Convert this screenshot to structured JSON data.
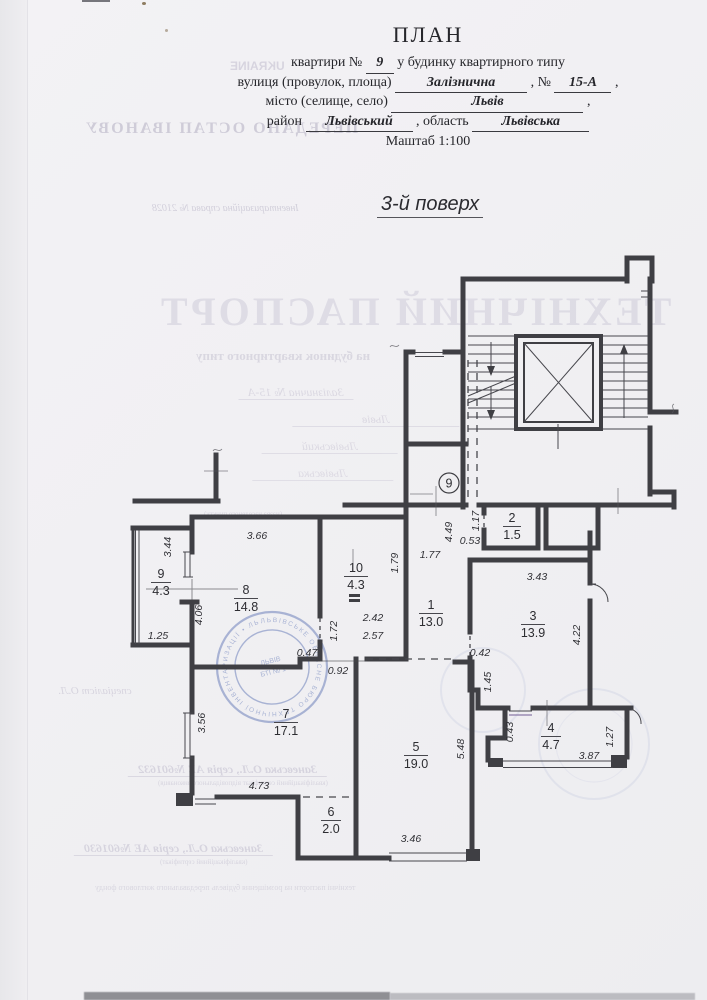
{
  "header": {
    "title": "ПЛАН",
    "line1_pre": "квартири №",
    "apartment_no": "9",
    "line1_post": "у будинку квартирного типу",
    "street_label": "вулиця (провулок, площа)",
    "street_value": "Залізнична",
    "street_no_label": ", №",
    "street_no_value": "15-А",
    "comma": ",",
    "city_label": "місто (селище, село)",
    "city_value": "Львів",
    "district_label": "район",
    "district_value": "Львівський",
    "region_label": ", область",
    "region_value": "Львівська",
    "scale": "Маштаб 1:100",
    "floor_title": "3-й поверх"
  },
  "plan": {
    "apartment_badge": "9",
    "rooms": [
      {
        "n": "1",
        "a": "13.0"
      },
      {
        "n": "2",
        "a": "1.5"
      },
      {
        "n": "3",
        "a": "13.9"
      },
      {
        "n": "4",
        "a": "4.7"
      },
      {
        "n": "5",
        "a": "19.0"
      },
      {
        "n": "6",
        "a": "2.0"
      },
      {
        "n": "7",
        "a": "17.1"
      },
      {
        "n": "8",
        "a": "14.8"
      },
      {
        "n": "9",
        "a": "4.3"
      },
      {
        "n": "10",
        "a": "4.3"
      }
    ],
    "dims": [
      {
        "t": "3.44"
      },
      {
        "t": "3.66"
      },
      {
        "t": "1.79"
      },
      {
        "t": "2.42"
      },
      {
        "t": "2.57"
      },
      {
        "t": "1.77"
      },
      {
        "t": "4.49"
      },
      {
        "t": "1.17"
      },
      {
        "t": "0.53"
      },
      {
        "t": "4.06"
      },
      {
        "t": "1.72"
      },
      {
        "t": "1.25"
      },
      {
        "t": "0.47"
      },
      {
        "t": "0.92"
      },
      {
        "t": "0.42"
      },
      {
        "t": "1.45"
      },
      {
        "t": "3.43"
      },
      {
        "t": "4.22"
      },
      {
        "t": "3.56"
      },
      {
        "t": "5.48"
      },
      {
        "t": "0.43"
      },
      {
        "t": "1.27"
      },
      {
        "t": "3.87"
      },
      {
        "t": "4.73"
      },
      {
        "t": "3.46"
      }
    ]
  },
  "bleed": {
    "ukraine": "UKRAINE",
    "owner_line": "ПЕРЕДАНО ОСТАП ІВАНОВУ",
    "inventory_line": "Інвентаризаційна справа №  21028",
    "passport_big": "ТЕХНІЧНИЙ ПАСПОРТ",
    "passport_sub": "на будинок квартирного типу",
    "form_street": "Залізнична    № 15-А",
    "form_city": "Львів",
    "form_district": "Львівський",
    "form_region": "Львівська",
    "form_note": "(назва населеного пункту)",
    "sig_small": "спеціаліст О.Л.",
    "cert1": "Заневська О.Л., серія АЕ №601632",
    "cert1_sub": "(кваліфікаційний сертифікат відповідального виконавця)",
    "cert2": "Заневська О.Л., серія АЕ №601630",
    "cert2_sub": "(кваліфікаційний сертифікат)",
    "footer_line": "технічні паспорти на розміщення будівель передавального житлового фонду"
  },
  "stamp": {
    "ring_text": "ЛЬВІВСЬКЕ ОБЛАСНЕ БЮРО ТЕХНІЧНОЇ ІНВЕНТАРИЗАЦІЇ • ЛЬВІВ •",
    "inner1": "ЛЬВІВ",
    "inner2": "БТІ № 1"
  }
}
